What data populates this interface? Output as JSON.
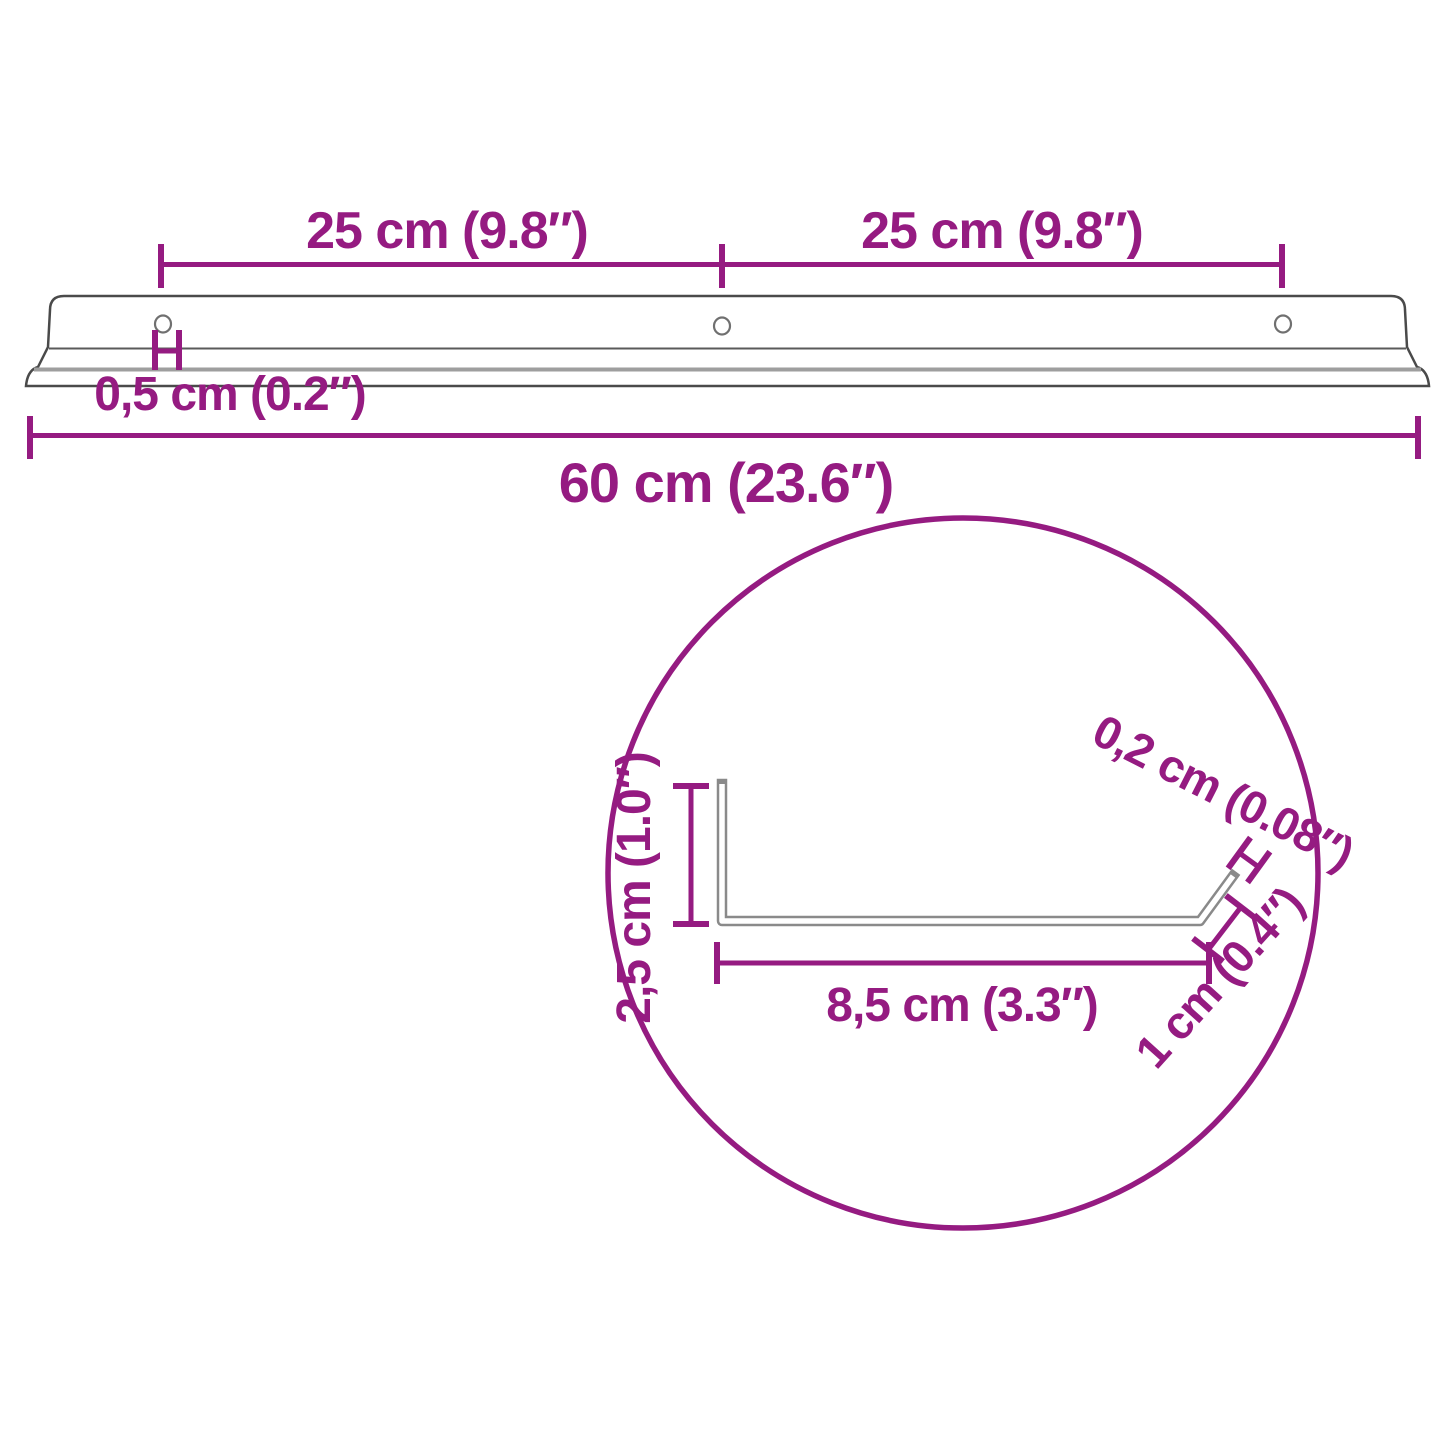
{
  "diagram_title": "Wall shelf dimension diagram",
  "colors": {
    "accent": "#951b81",
    "outline_gray": "#4a4a4a",
    "light_gray": "#9e9e9e"
  },
  "top_view": {
    "span_left": "25 cm (9.8″)",
    "span_right": "25 cm (9.8″)",
    "ledge_gap": "0,5 cm (0.2″)",
    "total_length": "60 cm (23.6″)"
  },
  "cross_section": {
    "height": "2,5 cm (1.0″)",
    "material_thickness": "0,2 cm (0.08″)",
    "base_depth": "8,5 cm (3.3″)",
    "lip_height": "1 cm (0.4″)"
  }
}
